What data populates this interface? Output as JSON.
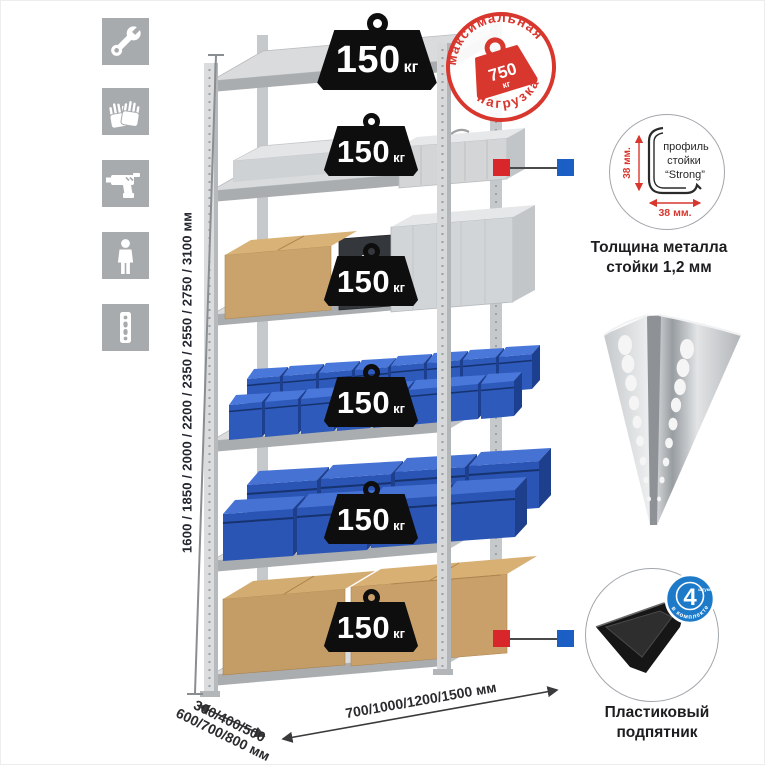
{
  "colors": {
    "accent_red": "#d8372e",
    "accent_blue": "#1c5fc4",
    "badge_blue": "#1d7ac9",
    "icon_gray": "#a7abae",
    "bin_blue": "#2e5abc",
    "cardboard": "#c9a26c",
    "weight_black": "#0e0e0e"
  },
  "left_icons": {
    "items": [
      {
        "name": "wrench-icon"
      },
      {
        "name": "gloves-icon"
      },
      {
        "name": "drill-icon"
      },
      {
        "name": "person-icon"
      },
      {
        "name": "rack-profile-icon"
      }
    ]
  },
  "height_scale": {
    "label": "1600 / 1850 / 2000 / 2200 / 2350 / 2550 / 2750 / 3100 мм"
  },
  "shelves": [
    {
      "load": "150",
      "unit": "кг"
    },
    {
      "load": "150",
      "unit": "кг"
    },
    {
      "load": "150",
      "unit": "кг"
    },
    {
      "load": "150",
      "unit": "кг"
    },
    {
      "load": "150",
      "unit": "кг"
    },
    {
      "load": "150",
      "unit": "кг"
    }
  ],
  "max_load_stamp": {
    "arc_top": "максимальная",
    "arc_bottom": "нагрузка",
    "value": "750",
    "unit": "кг"
  },
  "profile_feature": {
    "label_line1": "профиль",
    "label_line2": "стойки",
    "label_line3": "“Strong”",
    "dim_vertical": "38 мм.",
    "dim_horizontal": "38 мм.",
    "caption_line1": "Толщина металла",
    "caption_line2": "стойки 1,2 мм"
  },
  "foot_feature": {
    "badge_value": "4",
    "badge_word": "штуки",
    "badge_arc": "в комплекте",
    "caption_line1": "Пластиковый",
    "caption_line2": "подпятник"
  },
  "dimensions": {
    "depth_line1": "300/400/500",
    "depth_line2": "600/700/800 мм",
    "width_label": "700/1000/1200/1500 мм"
  }
}
